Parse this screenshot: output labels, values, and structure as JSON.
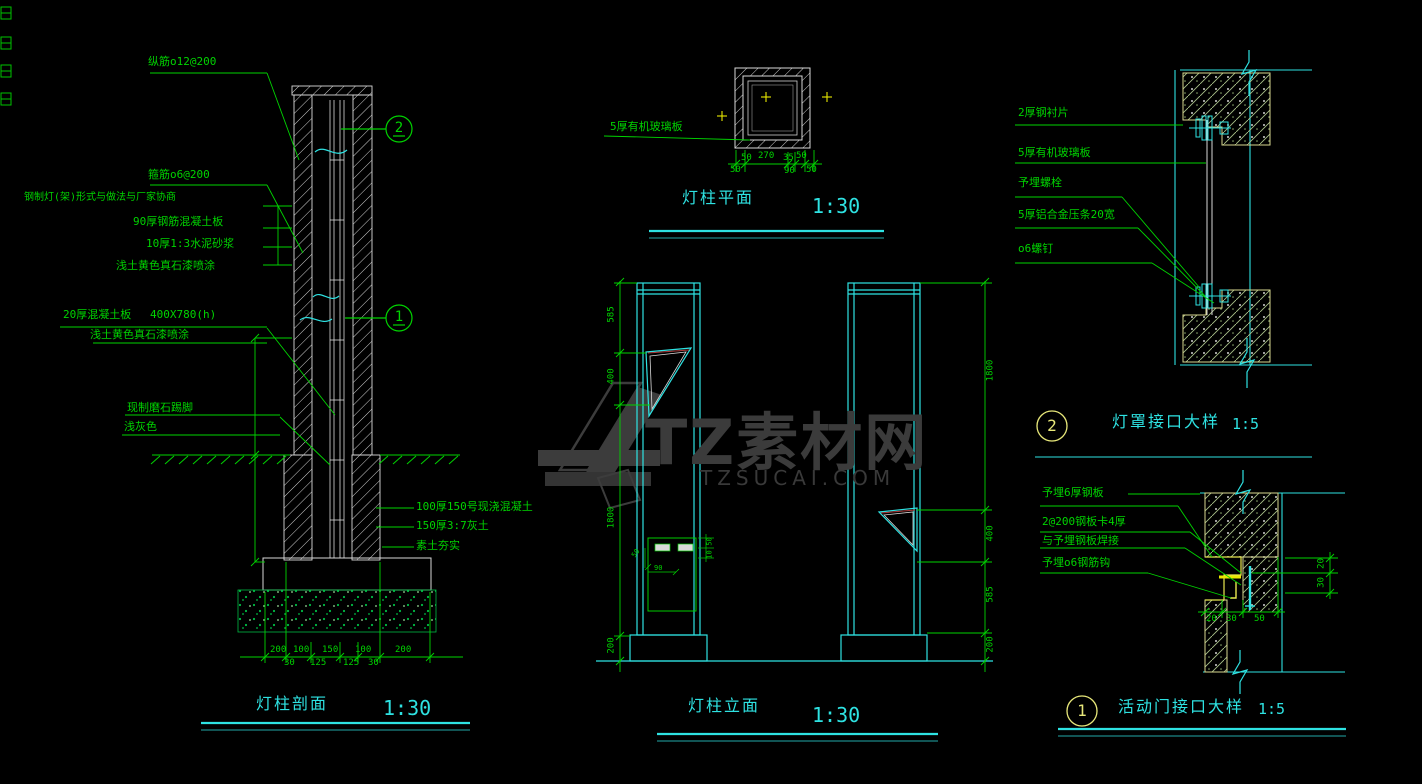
{
  "colors": {
    "background": "#000000",
    "line_green": "#00d400",
    "line_cyan": "#2ee2e2",
    "line_white": "#d9d9d9",
    "accent_yellow": "#e8e850",
    "hatch_red": "#b03a3a",
    "watermark_grey": "#3b3b3b"
  },
  "watermark": {
    "brand": "TZ素材网",
    "domain": "TZSUCAI.COM"
  },
  "section": {
    "title": "灯柱剖面",
    "scale": "1:30",
    "callout_top": "2",
    "callout_mid": "1",
    "labels": {
      "rebar_vertical": "纵筋o12@200",
      "rebar_stirrup": "箍筋o6@200",
      "lamp_note": "钢制灯(架)形式与做法与厂家协商",
      "rc_slab": "90厚钢筋混凝土板",
      "mortar": "10厚1:3水泥砂浆",
      "paint_upper": "浅土黄色真石漆喷涂",
      "concrete_board": "20厚混凝土板",
      "board_size": "400X780(h)",
      "paint_lower": "浅土黄色真石漆喷涂",
      "skirting": "现制磨石踢脚",
      "skirting_color": "浅灰色",
      "cast_concrete": "100厚150号现浇混凝土",
      "lime_soil": "150厚3:7灰土",
      "rammed_earth": "素土夯实"
    },
    "dims_top_row": [
      "200",
      "100",
      "150",
      "100",
      "200"
    ],
    "dims_bottom_row": [
      "30",
      "125",
      "125",
      "30"
    ]
  },
  "plan": {
    "title": "灯柱平面",
    "scale": "1:30",
    "label_glass": "5厚有机玻璃板",
    "dims_top": [
      "50",
      "270",
      "35",
      "50"
    ],
    "dims_bottom": [
      "50",
      "90",
      "50"
    ]
  },
  "elevation": {
    "title": "灯柱立面",
    "scale": "1:30",
    "dims_left": [
      "585",
      "400",
      "1800",
      "200"
    ],
    "dims_right": [
      "1800",
      "400",
      "585",
      "200"
    ],
    "door_dims": {
      "left": "50",
      "bottom": "90",
      "right_top": "50",
      "right_bottom": "10"
    }
  },
  "detail_lampshade": {
    "number": "2",
    "title": "灯罩接口大样",
    "scale": "1:5",
    "labels": [
      "2厚钢衬片",
      "5厚有机玻璃板",
      "予埋螺栓",
      "5厚铝合金压条20宽",
      "o6螺钉"
    ]
  },
  "detail_door": {
    "number": "1",
    "title": "活动门接口大样",
    "scale": "1:5",
    "labels": [
      "予埋6厚钢板",
      "2@200钢板卡4厚",
      "与予埋钢板焊接",
      "予埋o6钢筋钩"
    ],
    "dims_bottom": [
      "20",
      "30",
      "50"
    ],
    "dims_right": [
      "20",
      "30"
    ]
  }
}
